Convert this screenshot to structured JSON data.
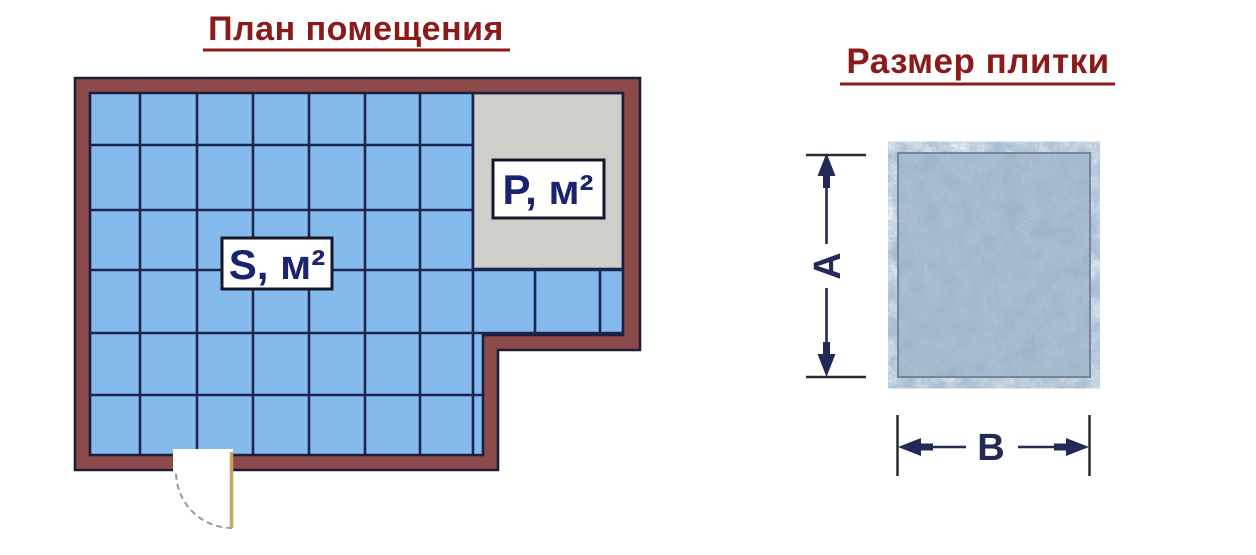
{
  "room_plan": {
    "title": "План помещения",
    "tiled_area_label": "S, м²",
    "untiled_area_label": "P, м²"
  },
  "tile_size": {
    "title": "Размер плитки",
    "height_label": "A",
    "width_label": "B"
  },
  "colors": {
    "title_text": "#8B1A1A",
    "wall_fill": "#8C4A4A",
    "wall_outline": "#1B1F3B",
    "tile_fill": "#85BBEC",
    "grid_line": "#1C2550",
    "untiled_area_fill": "#CFCEC9",
    "label_box_bg": "#FFFFFF",
    "label_box_border": "#15172B",
    "label_text": "#1B2370",
    "dimension_color": "#232A56",
    "tick_color": "#2B2B2B",
    "door_leaf": "#C9A35B",
    "door_swing": "#9A9A93",
    "tile_sample_base": "#A3B5C9",
    "tile_sample_border": "#74869B"
  }
}
